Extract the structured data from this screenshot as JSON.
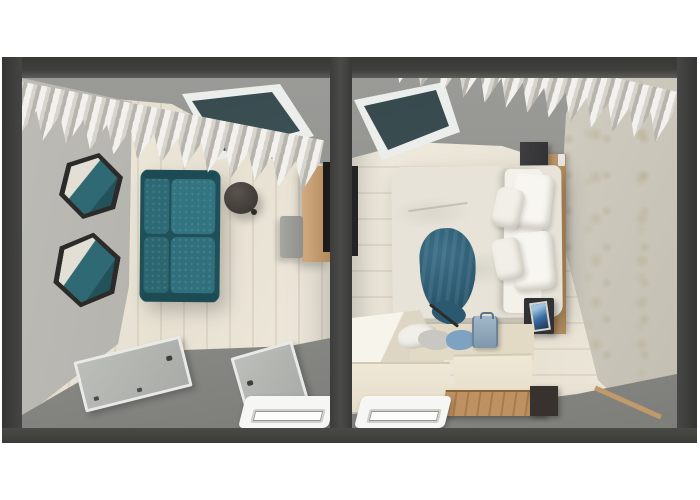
{
  "scene": {
    "label": "3D top-down floor plan render of a two-room apartment",
    "type": "3d-floorplan-render",
    "background_color": "#ffffff",
    "wall_frame_color": "#3e3e3c"
  },
  "palette": {
    "outer_walls": "#3e3e3c",
    "left_wall": "#b4b3ae",
    "top_wall": "#90908c",
    "wood_floor": "#ece7da",
    "sofa_teal": "#2e6a75",
    "blanket_teal": "#2c5a70",
    "curtain_white": "#e9e7e1",
    "window_glass": "#3d5358",
    "tv_panel_wood": "#c49d73",
    "wardrobe_cream": "#ece4d1",
    "bench_wood": "#b3875a",
    "radiator_white": "#f6f6f4",
    "bottom_plane_gray": "#8d8e8a",
    "wallpaper_beige": "#cfcbc0",
    "headboard_wood": "#c09a6a"
  },
  "rooms": {
    "living": {
      "label": "Living room",
      "items": {
        "curtain": "wavy white curtain",
        "window": "window with dark glazing",
        "sofa": "teal two-seat sofa",
        "coffee_table": "round dark coffee table",
        "mirror_1": "hexagonal wall mirror",
        "mirror_2": "hexagonal wall mirror",
        "tv_panel": "wooden TV wall panel",
        "tv": "wall-mounted TV",
        "media_cabinet": "gray media cabinet",
        "door_1": "entry door panel",
        "door_2": "secondary door panel",
        "radiator": "white radiator"
      }
    },
    "bedroom": {
      "label": "Bedroom",
      "items": {
        "curtain": "wavy white curtain",
        "window": "window with dark glazing",
        "bed": "double bed with white duvet",
        "pillows": "four white pillows",
        "blanket": "teal throw blanket",
        "headboard": "wooden headboard strip",
        "wall_cabinet": "dark wall cabinet",
        "nightstand": "dark nightstand",
        "photo_frame": "photo frame on nightstand",
        "wardrobe": "cream open wardrobe unit",
        "clothes": "folded clothes pile",
        "garment": "blue garment",
        "suitcase": "blue suitcase",
        "bench": "wood-slat bench",
        "side_cabinet": "small dark cabinet",
        "radiator": "white radiator",
        "tv": "wall-mounted TV on divider"
      }
    }
  }
}
